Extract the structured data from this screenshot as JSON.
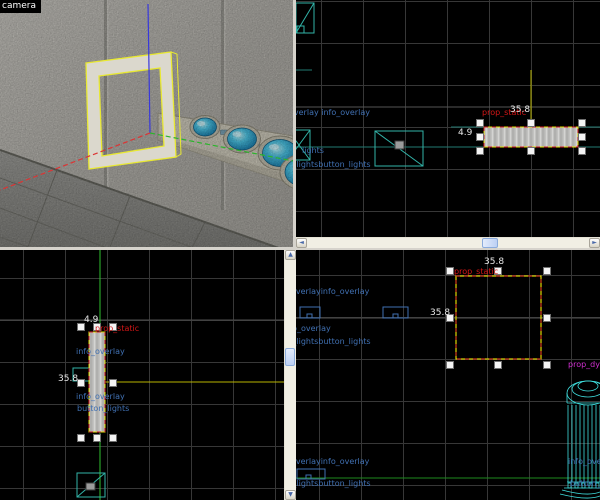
{
  "window": {
    "camera_label": "camera"
  },
  "colors": {
    "viewport_bg": "#000000",
    "grid_line": "#373737",
    "divider": "#d6d3cc",
    "entity_teal": "#32b3a8",
    "column_cyan": "#3fdede",
    "label_blue": "#4070b2",
    "label_red": "#d41616",
    "label_white": "#e8e8e8",
    "label_magenta": "#cf2fcf",
    "selection_yellow": "#e3d900",
    "selection_red": "#d42020",
    "axis_x_red": "#dc3434",
    "axis_y_green": "#2cb42c",
    "axis_z_blue": "#3838dc",
    "dome_blue": "#2fa8d4"
  },
  "viewport_top": {
    "label_overlay_pair": "info_overlay info_overlay",
    "label_lights": "lights",
    "label_button_pair": "button_lightsbutton_lights",
    "prop_label": "prop_static",
    "dim_width": "35.8",
    "dim_height": "4.9"
  },
  "viewport_front": {
    "dim_width": "4.9",
    "prop_label": "prop_static",
    "label_overlay_1": "info_overlay",
    "dim_height": "35.8",
    "label_overlay_2": "info_overlay",
    "label_button": "button_lights"
  },
  "viewport_side": {
    "label_overlay_pair_top": "info_overlayinfo_overlay",
    "label_overlay_mid": "info_overlay",
    "label_button_pair_mid": "button_lightsbutton_lights",
    "dim_width": "35.8",
    "prop_label": "prop_static",
    "dim_height": "35.8",
    "column_label": "prop_dynamic",
    "column_overlay_label": "info_overlay",
    "column_button_label": "button_lights",
    "label_overlay_pair_bottom": "info_overlayinfo_overlay",
    "label_button_pair_bottom": "button_lightsbutton_lights"
  },
  "scrollbar": {
    "left_arrow": "◄",
    "right_arrow": "►",
    "up_arrow": "▲",
    "down_arrow": "▼"
  }
}
